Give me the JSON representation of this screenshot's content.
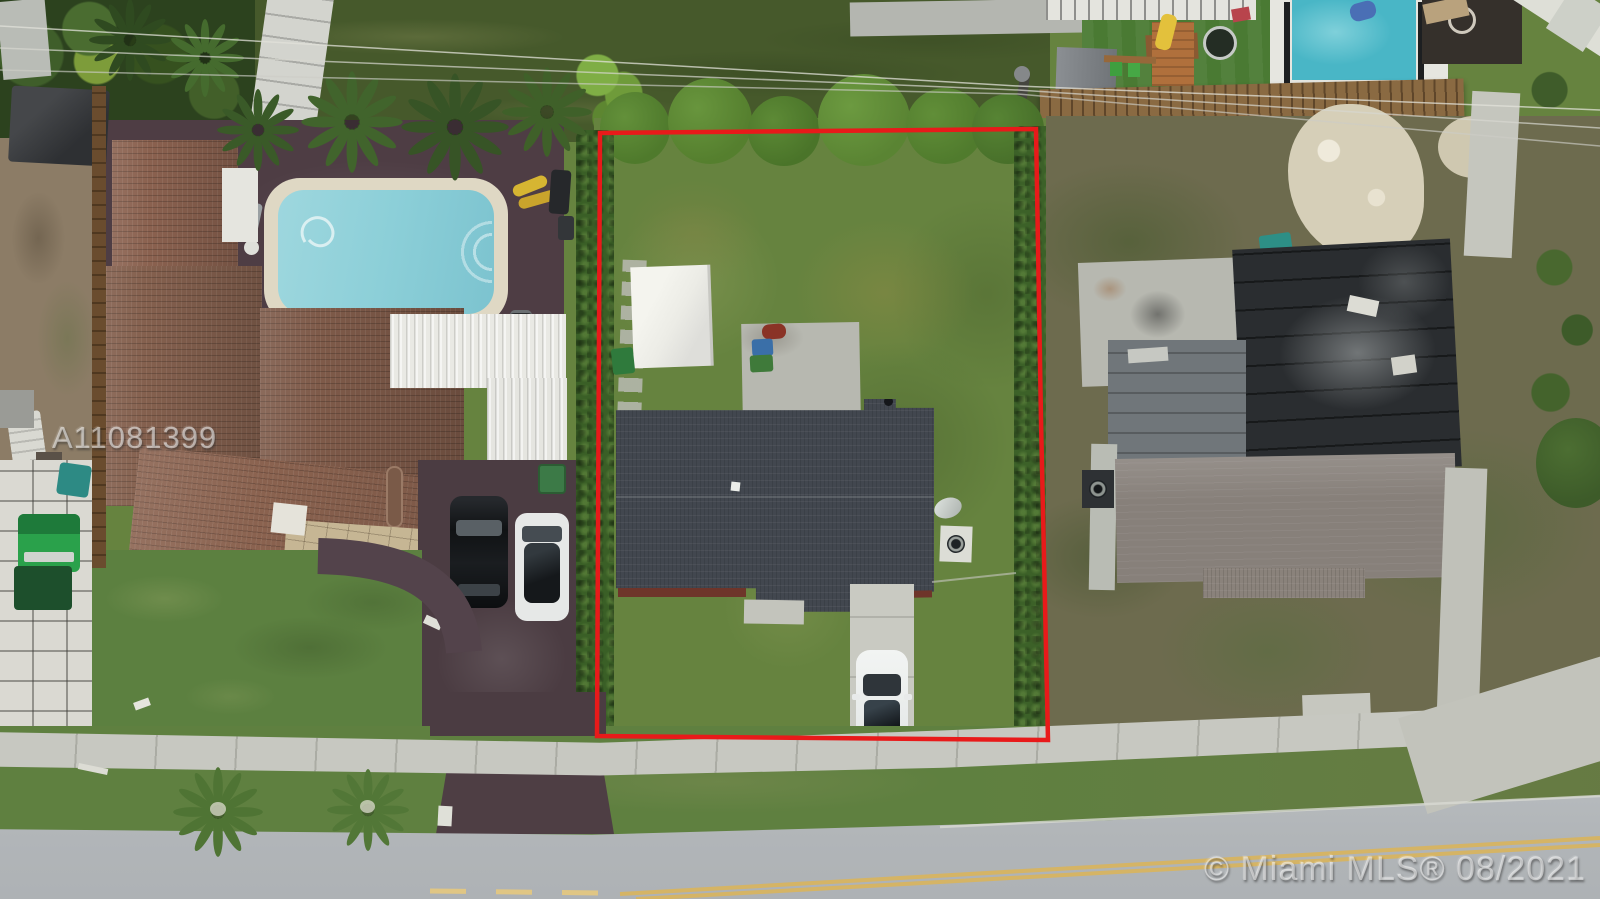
{
  "meta": {
    "type": "aerial-drone-photograph",
    "subject": "Overhead view of a residential lot outlined in red between neighboring single-family homes",
    "width": 1600,
    "height": 899
  },
  "watermarks": {
    "listing_id": "A11081399",
    "copyright": "© Miami MLS® 08/2021"
  },
  "boundary": {
    "label": "red property boundary outline",
    "points": "600,133 1036,129 1041,420 1048,740 597,736"
  },
  "colors": {
    "grass": "#66833f",
    "grass-front": "#5c8040",
    "grass-back": "#46592b",
    "turf": "#4a7a33",
    "hedge": "#3a5f26",
    "tree": "#4f7a2c",
    "dirt": "#8c7c66",
    "scrub": "#6d6b4e",
    "sand": "#d6cfb8",
    "road": "#b3b6b9",
    "concrete": "#c7c8c1",
    "concrete-dark": "#b7b8b0",
    "asphalt": "#4b3c42",
    "deck-wood": "#4e3d44",
    "pavers-white": "#dad9d2",
    "pavers-tan": "#c6b694",
    "roof-brown": "#8a614f",
    "roof-gray": "#42474f",
    "roof-flat-dark": "#2a2d30",
    "roof-shingle-light": "#87807a",
    "roof-white": "#e9e9e4",
    "shed-white": "#ecece6",
    "pool-water": "#8ccfd8",
    "pool-deck": "#dfd8c4",
    "pool-blue": "#49b6c6",
    "fence-wood": "#8a6a42",
    "yellow-line": "#d9b45c",
    "red-line": "#e81a1a"
  },
  "scene": {
    "setting": "Suburban homes from directly overhead, street along the bottom",
    "center_lot": [
      "backyard lawn",
      "white storage shed",
      "concrete patio with grill and trash bins",
      "gray shingle-roof house",
      "hedge-lined side boundaries",
      "concrete driveway with white car",
      "satellite dish and AC pad",
      "red boundary outline annotation"
    ],
    "left_property": [
      "brown barrel-tile roof house",
      "white metal patio roofs",
      "swimming pool with cream deck",
      "dark wood pool deck",
      "palm trees",
      "asphalt driveway with black SUV and white car",
      "curved front path",
      "green utility vehicle on white paver drive",
      "backyard gazebo and cluttered side yard"
    ],
    "right_property": [
      "dark flat-roof house with gray shingle additions",
      "concrete patio",
      "patchy dirt and grass yard",
      "sandy bare spots",
      "concrete walkways",
      "teal bin"
    ],
    "rear_neighbors": [
      "large lawn",
      "overhead power lines and utility pole",
      "wood privacy fence",
      "wood playset with yellow slide and swings",
      "trampoline",
      "blue swimming pool with white deck",
      "artificial turf",
      "white diagonal wall"
    ],
    "street": [
      "concrete sidewalk",
      "grass swale with two palms",
      "asphalt road with double yellow centerline",
      "driveway aprons"
    ]
  }
}
